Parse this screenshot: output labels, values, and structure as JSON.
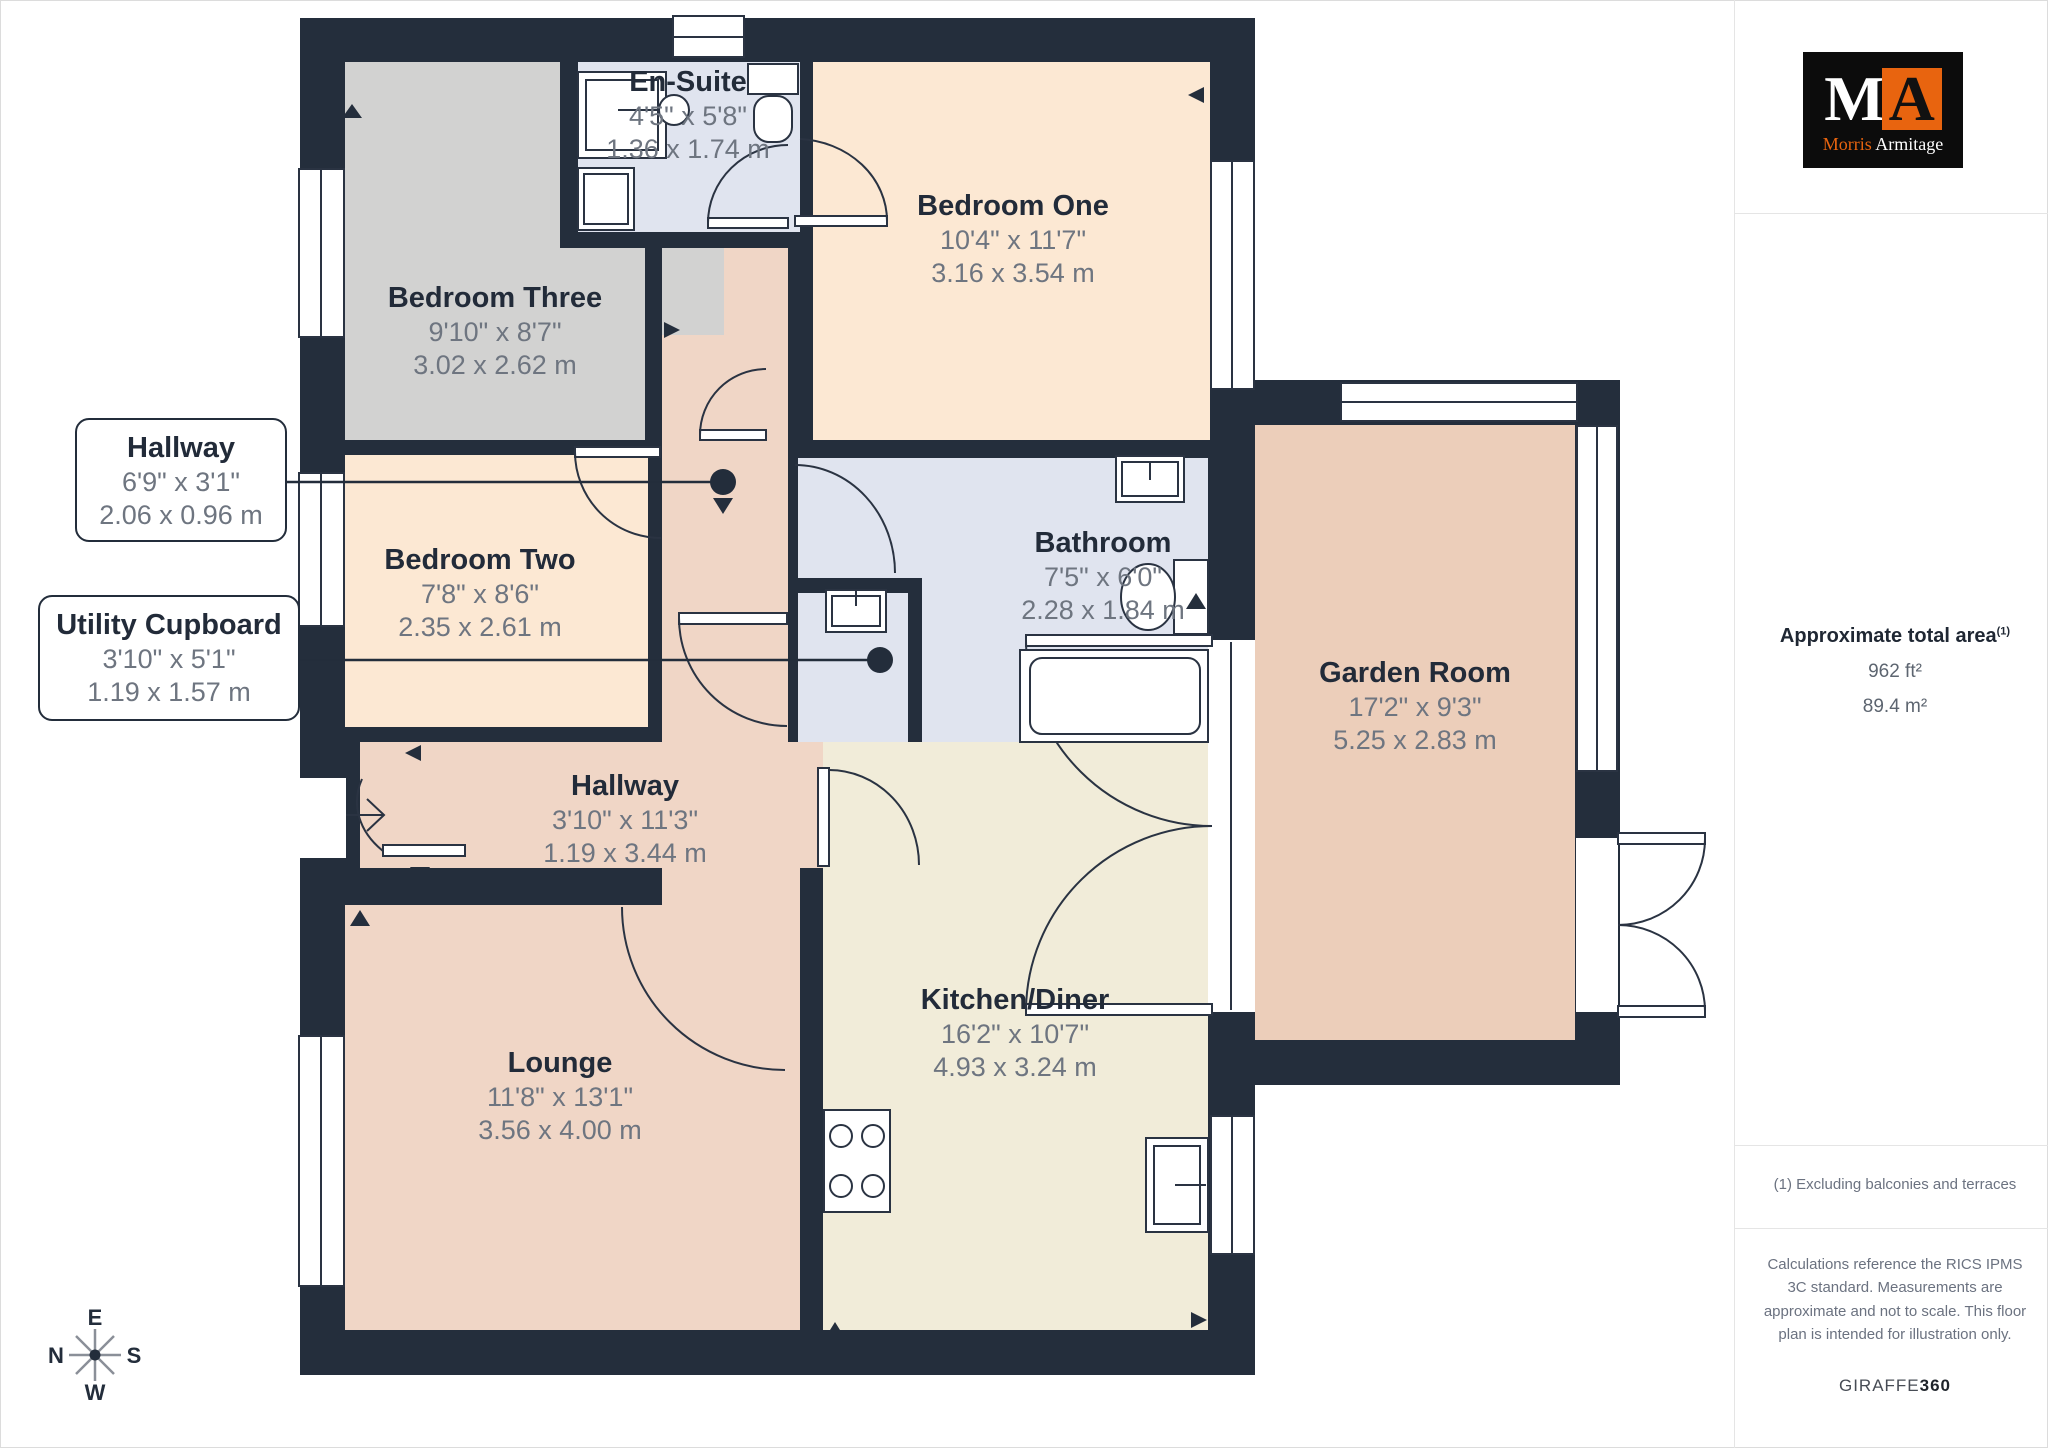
{
  "plan": {
    "rooms": [
      {
        "id": "ensuite",
        "name": "En-Suite",
        "imperial": "4'5\" x 5'8\"",
        "metric": "1.36 x 1.74 m"
      },
      {
        "id": "bedroom-one",
        "name": "Bedroom One",
        "imperial": "10'4\" x 11'7\"",
        "metric": "3.16 x 3.54 m"
      },
      {
        "id": "bedroom-three",
        "name": "Bedroom Three",
        "imperial": "9'10\" x 8'7\"",
        "metric": "3.02 x 2.62 m"
      },
      {
        "id": "bedroom-two",
        "name": "Bedroom Two",
        "imperial": "7'8\" x 8'6\"",
        "metric": "2.35 x 2.61 m"
      },
      {
        "id": "bathroom",
        "name": "Bathroom",
        "imperial": "7'5\" x 6'0\"",
        "metric": "2.28 x 1.84 m"
      },
      {
        "id": "hallway-main",
        "name": "Hallway",
        "imperial": "3'10\" x 11'3\"",
        "metric": "1.19 x 3.44 m"
      },
      {
        "id": "lounge",
        "name": "Lounge",
        "imperial": "11'8\" x 13'1\"",
        "metric": "3.56 x 4.00 m"
      },
      {
        "id": "kitchen-diner",
        "name": "Kitchen/Diner",
        "imperial": "16'2\" x 10'7\"",
        "metric": "4.93 x 3.24 m"
      },
      {
        "id": "garden-room",
        "name": "Garden Room",
        "imperial": "17'2\" x 9'3\"",
        "metric": "5.25 x 2.83 m"
      }
    ],
    "callouts": [
      {
        "id": "hallway",
        "name": "Hallway",
        "imperial": "6'9\" x 3'1\"",
        "metric": "2.06 x 0.96 m"
      },
      {
        "id": "utility-cupboard",
        "name": "Utility Cupboard",
        "imperial": "3'10\" x 5'1\"",
        "metric": "1.19 x 1.57 m"
      }
    ],
    "compass": {
      "top": "E",
      "left": "N",
      "right": "S",
      "bottom": "W"
    },
    "fixtures": [
      "shower",
      "cabinet",
      "basin",
      "toilet",
      "bath",
      "hob",
      "kitchen-sink",
      "utility-sink"
    ]
  },
  "sidebar": {
    "logo": {
      "m": "M",
      "a": "A",
      "name_first": "Morris",
      "name_last": "Armitage"
    },
    "area": {
      "heading": "Approximate total area",
      "superscript": "(1)",
      "imperial": "962 ft²",
      "metric": "89.4 m²"
    },
    "footnote": "(1) Excluding balconies and terraces",
    "disclaimer": "Calculations reference the RICS IPMS 3C standard. Measurements are approximate and not to scale. This floor plan is intended for illustration only.",
    "brand": {
      "first": "GIRAFFE",
      "second": "360"
    }
  },
  "colors": {
    "wall": "#242e3c",
    "bedroom_fill": "#fce8d3",
    "bedroom_three_fill": "#d2d2d1",
    "bathroom_fill": "#e0e4ef",
    "hallway_fill": "#f0d6c6",
    "kitchen_fill": "#f1ecd9",
    "garden_fill": "#ecceba",
    "dim_text": "#6e7580",
    "name_text": "#222b39",
    "brand_orange": "#e8640f"
  }
}
